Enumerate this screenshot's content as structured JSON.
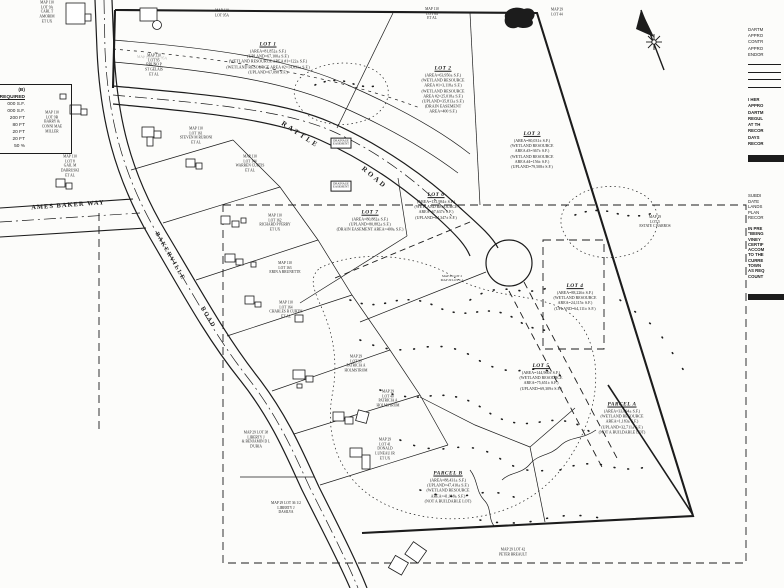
{
  "page": {
    "ink": "#1c1c1c",
    "paper": "#fcfcfa",
    "faint": "#b0b0ae"
  },
  "zoning_table": {
    "header": "(B)",
    "subheader": "REQUIRED",
    "rows": [
      "000 S.F.",
      "000 S.F.",
      "200 FT",
      "80 FT",
      "20 FT",
      "20 FT",
      "50 %"
    ]
  },
  "labels": [
    {
      "name": "lot-1-label",
      "x": 268,
      "y": 58,
      "fs": 4,
      "title": "LOT 1",
      "lines": [
        "(AREA=81,852± S.F.)",
        "(UPLAND=67,100± S.F.)",
        "(WETLAND RESOURCE AREA #1=122± S.F.)",
        "(WETLAND RESOURCE AREA #2=14,631± S.F.)",
        "(UPLAND=67,098 S.F.)"
      ]
    },
    {
      "name": "lot-2-label",
      "x": 443,
      "y": 90,
      "fs": 4,
      "title": "LOT 2",
      "lines": [
        "(AREA=63,950± S.F.)",
        "(WETLAND RESOURCE",
        "AREA #1=3,118± S.F.)",
        "(WETLAND RESOURCE",
        "AREA #2=25,018± S.F.)",
        "(UPLAND=35,813± S.F.)",
        "(DRAIN EASEMENT",
        "AREA=400 S.F.)"
      ]
    },
    {
      "name": "lot-3-label",
      "x": 532,
      "y": 150,
      "fs": 4,
      "title": "LOT 3",
      "lines": [
        "(AREA=80,031± S.F.)",
        "(WETLAND RESOURCE",
        "AREA #3=367± S.F.)",
        "(WETLAND RESOURCE",
        "AREA #4=156± S.F.)",
        "(UPLAND=79,508± S.F.)"
      ]
    },
    {
      "name": "lot-4-label",
      "x": 575,
      "y": 297,
      "fs": 4,
      "title": "LOT 4",
      "lines": [
        "(AREA=88,226± S.F.)",
        "(WETLAND RESOURCE",
        "AREA=24,115± S.F.)",
        "(UPLAND=64,111± S.F.)"
      ]
    },
    {
      "name": "lot-5-label",
      "x": 541,
      "y": 377,
      "fs": 4,
      "title": "LOT 5",
      "lines": [
        "(AREA=144,960± S.F.)",
        "(WETLAND RESOURCE",
        "AREA=75,651± S.F.)",
        "(UPLAND=69,309± S.F.)"
      ]
    },
    {
      "name": "lot-6-label",
      "x": 436,
      "y": 206,
      "fs": 4,
      "title": "LOT 6",
      "lines": [
        "(AREA=131,984± S.F.)",
        "(WETLAND RESOURCE",
        "AREA=67,637± S.F.)",
        "(UPLAND=64,347± S.F.)"
      ]
    },
    {
      "name": "lot-7-label",
      "x": 370,
      "y": 221,
      "fs": 4,
      "title": "LOT 7",
      "lines": [
        "(AREA=80,882± S.F.)",
        "(UPLAND=80,882± S.F.)",
        "(DRAIN EASEMENT AREA=400± S.F.)"
      ]
    },
    {
      "name": "parcel-a-label",
      "x": 622,
      "y": 418,
      "fs": 4,
      "title": "PARCEL A",
      "lines": [
        "(AREA=33,894± S.F.)",
        "(WETLAND RESOURCE",
        "AREA=1,183± S.F.)",
        "(UPLAND=32,711± S.F.)",
        "(NOT A BUILDABLE LOT)"
      ]
    },
    {
      "name": "parcel-b-label",
      "x": 448,
      "y": 487,
      "fs": 4,
      "title": "PARCEL B",
      "lines": [
        "(AREA=88,431± S.F.)",
        "(UPLAND=47,410± S.F.)",
        "(WETLAND RESOURCE",
        "AREA=41,018± S.F.)",
        "(NOT A BUILDABLE LOT)"
      ]
    },
    {
      "name": "abutter-amorim",
      "x": 47,
      "y": 12,
      "fs": 3.6,
      "lines": [
        "MAP 110",
        "LOT 9A",
        "CARL T",
        "AMORIM",
        "ET UX"
      ]
    },
    {
      "name": "abutter-stgelais",
      "x": 154,
      "y": 65,
      "fs": 3.6,
      "lines": [
        "MAP 110",
        "LOT 95",
        "BRUNO P",
        "ST GELAIS",
        "ET AL"
      ]
    },
    {
      "name": "abutter-miller",
      "x": 52,
      "y": 122,
      "fs": 3.6,
      "lines": [
        "MAP 110",
        "LOT 9B",
        "BARRY &",
        "CONNI MAE",
        "MILLER"
      ]
    },
    {
      "name": "abutter-dabruski",
      "x": 70,
      "y": 166,
      "fs": 3.6,
      "lines": [
        "MAP 110",
        "LOT 8",
        "GAIL M",
        "DABRUSKI",
        "ET AL"
      ]
    },
    {
      "name": "abutter-lot95a-top",
      "x": 222,
      "y": 13,
      "fs": 3.6,
      "lines": [
        "MAP 110",
        "LOT 95A"
      ]
    },
    {
      "name": "abutter-lot84",
      "x": 432,
      "y": 14,
      "fs": 3.6,
      "lines": [
        "MAP 110",
        "LOT 84",
        "ET AL"
      ]
    },
    {
      "name": "abutter-lot44",
      "x": 557,
      "y": 12,
      "fs": 3.6,
      "lines": [
        "MAP 29",
        "LOT 44"
      ]
    },
    {
      "name": "abutter-ruboni",
      "x": 196,
      "y": 136,
      "fs": 3.6,
      "lines": [
        "MAP 110",
        "LOT 161",
        "STEVEN M RUBONI",
        "ET AL"
      ]
    },
    {
      "name": "abutter-wcurtis",
      "x": 250,
      "y": 164,
      "fs": 3.6,
      "lines": [
        "MAP 110",
        "LOT 144",
        "WARREN CURTIS",
        "ET AL"
      ]
    },
    {
      "name": "abutter-perry",
      "x": 275,
      "y": 223,
      "fs": 3.6,
      "lines": [
        "MAP 110",
        "LOT 162",
        "RICHARD P PERRY",
        "ET UX"
      ]
    },
    {
      "name": "abutter-brunette",
      "x": 285,
      "y": 268,
      "fs": 3.6,
      "lines": [
        "MAP 110",
        "LOT 163",
        "ERIN A BRUNETTE"
      ]
    },
    {
      "name": "abutter-ccurtis",
      "x": 286,
      "y": 310,
      "fs": 3.6,
      "lines": [
        "MAP 110",
        "LOT 164",
        "CHARLES R CURTIS",
        "ET AL"
      ]
    },
    {
      "name": "abutter-holmstrom-39",
      "x": 356,
      "y": 364,
      "fs": 3.6,
      "lines": [
        "MAP 29",
        "LOT 39",
        "PATRICIA A",
        "HOLMSTROM"
      ]
    },
    {
      "name": "abutter-holmstrom-40",
      "x": 388,
      "y": 399,
      "fs": 3.6,
      "lines": [
        "MAP 29",
        "LOT 40",
        "PATRICIA A",
        "HOLMSTROM"
      ]
    },
    {
      "name": "abutter-luneau",
      "x": 385,
      "y": 449,
      "fs": 3.6,
      "lines": [
        "MAP 29",
        "LOT 41",
        "DONALD",
        "LUNEAU JR",
        "ET UX"
      ]
    },
    {
      "name": "abutter-duria",
      "x": 256,
      "y": 440,
      "fs": 3.6,
      "lines": [
        "MAP 29 LOT 38",
        "LIBERTY J",
        "& BENJAMIN D L",
        "D'URIA"
      ]
    },
    {
      "name": "abutter-dasilva",
      "x": 286,
      "y": 508,
      "fs": 3.6,
      "lines": [
        "MAP 29 LOT 36 1/2",
        "LIBERTY J",
        "DASILVA"
      ]
    },
    {
      "name": "abutter-breault",
      "x": 513,
      "y": 552,
      "fs": 3.6,
      "lines": [
        "MAP 29 LOT 42",
        "PETER BREAULT"
      ]
    },
    {
      "name": "abutter-barros",
      "x": 655,
      "y": 222,
      "fs": 3.6,
      "lines": [
        "MAP 29",
        "LOT 5",
        "ESTATE C BARROS"
      ]
    },
    {
      "name": "ghost-lot95a",
      "x": 152,
      "y": 58,
      "fs": 3.8,
      "rot": 3,
      "cls": "faint",
      "lines": [
        "MAP 110 LOT 95A"
      ]
    },
    {
      "name": "drainage-easement-1",
      "x": 341,
      "y": 143,
      "fs": 3,
      "cls": "boxed",
      "lines": [
        "DRAINAGE",
        "EASEMENT"
      ]
    },
    {
      "name": "drainage-easement-2",
      "x": 341,
      "y": 186,
      "fs": 3,
      "cls": "boxed",
      "lines": [
        "DRAINAGE",
        "EASEMENT"
      ]
    },
    {
      "name": "old-lot-line-note",
      "x": 452,
      "y": 278,
      "fs": 3.2,
      "lines": [
        "MAP 29 LOT 2",
        "MAP 29 LOT 1-1"
      ]
    },
    {
      "name": "road-label-rattle",
      "x": 300,
      "y": 135,
      "fs": 7,
      "rot": 33,
      "ls": 2.5,
      "cls": "road",
      "lines": [
        "RATTLE"
      ]
    },
    {
      "name": "road-label-rattle-road",
      "x": 374,
      "y": 178,
      "fs": 7,
      "rot": 40,
      "ls": 2.5,
      "cls": "road",
      "lines": [
        "ROAD"
      ]
    },
    {
      "name": "road-label-ames-baker-way",
      "x": 68,
      "y": 206,
      "fs": 6.5,
      "rot": -4,
      "ls": 1,
      "cls": "road",
      "lines": [
        "AMES BAKER WAY"
      ]
    },
    {
      "name": "road-label-bakerville",
      "x": 169,
      "y": 257,
      "fs": 6,
      "rot": 60,
      "ls": 1.5,
      "cls": "road",
      "lines": [
        "BAKERVILLE"
      ]
    },
    {
      "name": "road-label-bakerville-road",
      "x": 207,
      "y": 318,
      "fs": 6,
      "rot": 60,
      "ls": 1.5,
      "cls": "road",
      "lines": [
        "ROAD"
      ]
    }
  ],
  "right_margin": {
    "blocks": [
      {
        "name": "approval-block",
        "top": 27,
        "lh": 6.2,
        "bold": false,
        "lines": [
          "DARTM",
          "APPRO",
          "CONTR",
          "APPRO",
          "ENDOR"
        ]
      },
      {
        "name": "certification-block",
        "top": 97,
        "lh": 6.3,
        "bold": true,
        "lines": [
          "I HER",
          "APPRO",
          "DARTM",
          "REGUL",
          "AT TH",
          "RECOR",
          "DAYS",
          "RECOR"
        ]
      },
      {
        "name": "recording-block",
        "top": 193,
        "lh": 5.6,
        "bold": false,
        "lines": [
          "SUBDI",
          "DATE",
          "LANDS",
          "PLAN",
          "RECOR"
        ]
      },
      {
        "name": "notes-block",
        "top": 226,
        "lh": 5.3,
        "bold": true,
        "lines": [
          "IN PRE",
          "\"BEING",
          "VINEY",
          "CERTIF",
          "ACCOM",
          "TO THE",
          "CURRE",
          "TOWN",
          "AS REQ",
          "COUNT"
        ]
      }
    ]
  }
}
